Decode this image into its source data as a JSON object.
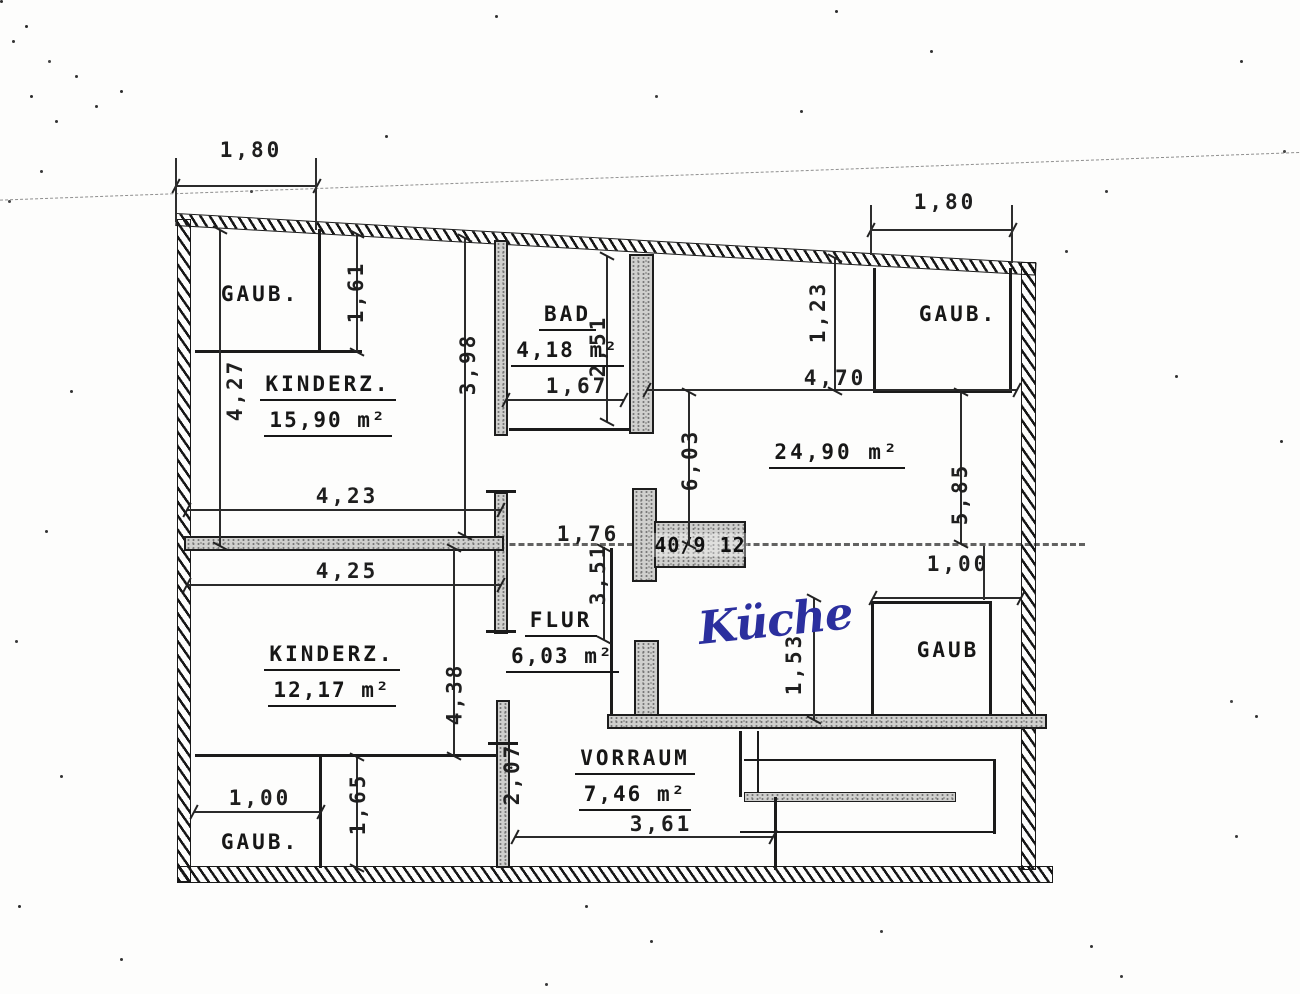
{
  "palette": {
    "ink": "#1c1c1c",
    "wall_fill_gray": "#cfcfcd",
    "handwriting_blue": "#2b2f9e",
    "paper": "#fdfdfc"
  },
  "rooms": {
    "gaub_top_left": {
      "name": "GAUB."
    },
    "kinderz_top": {
      "name": "KINDERZ.",
      "area": "15,90 m²"
    },
    "bad": {
      "name": "BAD",
      "area": "4,18 m²"
    },
    "gaub_top_right": {
      "name": "GAUB."
    },
    "room_24_90": {
      "area": "24,90 m²"
    },
    "flur": {
      "name": "FLUR",
      "area": "6,03 m²"
    },
    "kueche_handwritten": {
      "name": "Küche"
    },
    "gaub_mid_right": {
      "name": "GAUB"
    },
    "kinderz_bottom": {
      "name": "KINDERZ.",
      "area": "12,17 m²"
    },
    "gaub_bottom_left": {
      "name": "GAUB."
    },
    "vorraum": {
      "name": "VORRAUM",
      "area": "7,46 m²"
    }
  },
  "dims": {
    "d180_top_left": "1,80",
    "d180_top_right": "1,80",
    "d161": "1,61",
    "d427": "4,27",
    "d398": "3,98",
    "d251": "2,51",
    "d167": "1,67",
    "d470": "4,70",
    "d123": "1,23",
    "d603": "6,03",
    "d585": "5,85",
    "d423": "4,23",
    "d425": "4,25",
    "d176": "1,76",
    "d351": "3,51",
    "d100_right": "1,00",
    "d153": "1,53",
    "d438": "4,38",
    "d100_gaub": "1,00",
    "d165": "1,65",
    "d207": "2,07",
    "d361": "3,61"
  },
  "shaft": {
    "label": "40/9 12"
  }
}
